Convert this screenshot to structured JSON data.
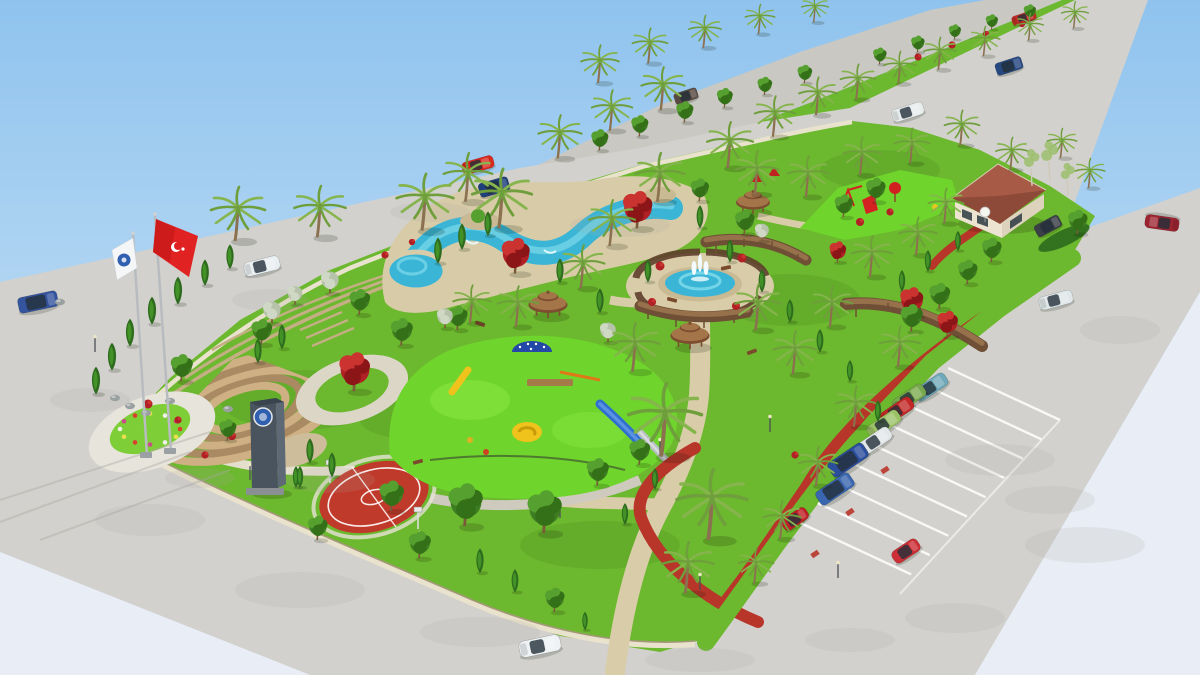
{
  "meta": {
    "alt": "Aerial 3D architectural rendering of a landscaped municipal park with pools, fountain, gazebos, playgrounds, basketball court, amphitheater, flags, parking lot and surrounding roads with cars"
  },
  "palette": {
    "sky_top": "#8fc3ee",
    "sky_bottom": "#ddecf8",
    "haze": "#e9edf5",
    "pavement": "#d2d1cd",
    "road": "#c9c8c3",
    "park_grass": "#6cb82e",
    "grass_bright": "#7ecf37",
    "rubber_green": "#6fd42c",
    "water": "#3ab5d6",
    "water_light": "#8ce2ee",
    "stone_deck": "#d8cca8",
    "sand_path": "#d9cda9",
    "track_red": "#b8352a",
    "court_red": "#c03a2b",
    "wall_light": "#e9e2cc",
    "wall_dark": "#a39878",
    "terrace_tan": "#c4ae84",
    "amphi_tan": "#cfb084",
    "amphi_brown": "#a98a62",
    "palm_frond": "#6f9e3c",
    "palm_frond2": "#86b44d",
    "palm_trunk": "#8c7150",
    "conifer_dark": "#2e6b1e",
    "conifer_light": "#429227",
    "tree_green_1": "#3f7d23",
    "tree_green_2": "#55a02e",
    "tree_green_3": "#347018",
    "red_tree_1": "#b02024",
    "red_tree_2": "#cb3330",
    "red_tree_3": "#8c1518",
    "silver_1": "#b7c2ab",
    "silver_2": "#cfd8c4",
    "birch_leaf": "#9cc06c",
    "gazebo_dark": "#7c4e2f",
    "gazebo_light": "#a5754a",
    "pergola_dark": "#6f4f35",
    "pergola_light": "#96714c",
    "tower_wall": "#8a5a3a",
    "tower_roof": "#9e2a2a",
    "tower_win": "#4a3322",
    "building_roof": "#8e4a38",
    "building_roof_light": "#a75a45",
    "building_wall": "#ece4d0",
    "glass_dark": "#233039",
    "flag_red": "#e02222",
    "flag_white": "#f4f6f8",
    "emblem_blue": "#2f5fae",
    "monument_dark": "#49545e",
    "monument_light": "#5d6974",
    "lamp_gray": "#4a4f52",
    "lamp_head": "#ece6c4",
    "rock_gray": "#9aa0a0",
    "bench_brown": "#7a4a2c",
    "white_line": "#ffffff",
    "blotch": "#a9a7a2",
    "fence_dark": "#3c4a32"
  },
  "scene": {
    "cars": [
      {
        "t": "van",
        "c": "#35549e",
        "x": 38,
        "y": 302,
        "r": -12,
        "s": 1.0
      },
      {
        "t": "sedan",
        "c": "#e9eff1",
        "x": 262,
        "y": 266,
        "r": -14,
        "s": 0.95
      },
      {
        "t": "sedan",
        "c": "#d8291f",
        "x": 478,
        "y": 165,
        "r": -16,
        "s": 0.85
      },
      {
        "t": "suv",
        "c": "#1f3f7a",
        "x": 494,
        "y": 187,
        "r": -16,
        "s": 0.9
      },
      {
        "t": "suv",
        "c": "#584a42",
        "x": 686,
        "y": 96,
        "r": -18,
        "s": 0.7
      },
      {
        "t": "sedan",
        "c": "#bf2d26",
        "x": 1024,
        "y": 18,
        "r": -18,
        "s": 0.65
      },
      {
        "t": "suv",
        "c": "#27477f",
        "x": 1009,
        "y": 66,
        "r": -18,
        "s": 0.8
      },
      {
        "t": "sedan",
        "c": "#e8edee",
        "x": 908,
        "y": 112,
        "r": -18,
        "s": 0.85
      },
      {
        "t": "sedan",
        "c": "#9c2430",
        "x": 1162,
        "y": 223,
        "r": 188,
        "s": 0.9
      },
      {
        "t": "sedan",
        "c": "#dfe7e8",
        "x": 1056,
        "y": 300,
        "r": -15,
        "s": 0.9
      },
      {
        "t": "suv",
        "c": "#3a3f46",
        "x": 1048,
        "y": 226,
        "r": -28,
        "s": 0.8
      },
      {
        "t": "sedan",
        "c": "#6fa8b8",
        "x": 931,
        "y": 387,
        "r": -34,
        "s": 0.95
      },
      {
        "t": "sedan",
        "c": "#79a94e",
        "x": 909,
        "y": 398,
        "r": -34,
        "s": 0.95
      },
      {
        "t": "sedan",
        "c": "#c22626",
        "x": 897,
        "y": 411,
        "r": -34,
        "s": 0.95
      },
      {
        "t": "sedan",
        "c": "#9cc268",
        "x": 884,
        "y": 424,
        "r": -34,
        "s": 0.95
      },
      {
        "t": "sedan",
        "c": "#e2e7e9",
        "x": 875,
        "y": 441,
        "r": -34,
        "s": 0.95
      },
      {
        "t": "van",
        "c": "#2b4e9d",
        "x": 848,
        "y": 460,
        "r": -34,
        "s": 1.05
      },
      {
        "t": "van",
        "c": "#3a66b0",
        "x": 835,
        "y": 489,
        "r": -34,
        "s": 1.0
      },
      {
        "t": "hatch",
        "c": "#bf1f26",
        "x": 795,
        "y": 519,
        "r": -34,
        "s": 0.95
      },
      {
        "t": "hatch",
        "c": "#cc2f36",
        "x": 906,
        "y": 551,
        "r": -34,
        "s": 1.0
      },
      {
        "t": "sedan",
        "c": "#eef2f4",
        "x": 540,
        "y": 646,
        "r": -12,
        "s": 1.1
      }
    ],
    "palms": [
      [
        238,
        208,
        1.0
      ],
      [
        320,
        206,
        0.95
      ],
      [
        425,
        196,
        1.05
      ],
      [
        468,
        172,
        0.9
      ],
      [
        502,
        192,
        1.1
      ],
      [
        560,
        132,
        0.8
      ],
      [
        612,
        106,
        0.75
      ],
      [
        663,
        84,
        0.8
      ],
      [
        730,
        140,
        0.85
      ],
      [
        775,
        112,
        0.75
      ],
      [
        818,
        92,
        0.7
      ],
      [
        858,
        78,
        0.65
      ],
      [
        900,
        64,
        0.6
      ],
      [
        940,
        50,
        0.6
      ],
      [
        985,
        38,
        0.55
      ],
      [
        1030,
        24,
        0.5
      ],
      [
        1075,
        12,
        0.5
      ],
      [
        660,
        172,
        0.9
      ],
      [
        612,
        218,
        0.85
      ],
      [
        583,
        262,
        0.8
      ],
      [
        757,
        168,
        0.8
      ],
      [
        808,
        172,
        0.75
      ],
      [
        862,
        152,
        0.7
      ],
      [
        912,
        142,
        0.65
      ],
      [
        962,
        124,
        0.65
      ],
      [
        1012,
        150,
        0.6
      ],
      [
        1062,
        140,
        0.55
      ],
      [
        1090,
        170,
        0.55
      ],
      [
        665,
        412,
        1.35
      ],
      [
        712,
        497,
        1.3
      ],
      [
        688,
        562,
        0.95
      ],
      [
        635,
        342,
        0.9
      ],
      [
        758,
        302,
        0.85
      ],
      [
        795,
        348,
        0.8
      ],
      [
        832,
        302,
        0.75
      ],
      [
        872,
        252,
        0.75
      ],
      [
        918,
        232,
        0.7
      ],
      [
        946,
        202,
        0.65
      ],
      [
        900,
        342,
        0.75
      ],
      [
        856,
        402,
        0.75
      ],
      [
        818,
        462,
        0.72
      ],
      [
        782,
        516,
        0.7
      ],
      [
        756,
        562,
        0.65
      ],
      [
        518,
        302,
        0.75
      ],
      [
        472,
        300,
        0.7
      ],
      [
        600,
        60,
        0.7
      ],
      [
        650,
        42,
        0.65
      ],
      [
        705,
        28,
        0.6
      ],
      [
        760,
        16,
        0.55
      ],
      [
        815,
        6,
        0.5
      ]
    ],
    "conifers": [
      [
        96,
        382,
        0.9
      ],
      [
        112,
        358,
        0.9
      ],
      [
        130,
        334,
        0.9
      ],
      [
        152,
        312,
        0.9
      ],
      [
        178,
        292,
        0.9
      ],
      [
        205,
        274,
        0.85
      ],
      [
        230,
        258,
        0.8
      ],
      [
        258,
        352,
        0.8
      ],
      [
        282,
        338,
        0.8
      ],
      [
        310,
        452,
        0.8
      ],
      [
        332,
        466,
        0.8
      ],
      [
        272,
        472,
        0.75
      ],
      [
        296,
        478,
        0.7
      ],
      [
        438,
        252,
        0.85
      ],
      [
        462,
        238,
        0.85
      ],
      [
        488,
        225,
        0.8
      ],
      [
        560,
        272,
        0.8
      ],
      [
        600,
        302,
        0.8
      ],
      [
        648,
        272,
        0.75
      ],
      [
        700,
        218,
        0.75
      ],
      [
        730,
        252,
        0.75
      ],
      [
        762,
        282,
        0.75
      ],
      [
        790,
        312,
        0.75
      ],
      [
        820,
        342,
        0.75
      ],
      [
        850,
        372,
        0.7
      ],
      [
        878,
        412,
        0.7
      ],
      [
        480,
        562,
        0.8
      ],
      [
        515,
        582,
        0.75
      ],
      [
        300,
        478,
        0.7
      ],
      [
        902,
        282,
        0.7
      ],
      [
        928,
        262,
        0.7
      ],
      [
        958,
        242,
        0.65
      ],
      [
        655,
        480,
        0.7
      ],
      [
        625,
        515,
        0.7
      ],
      [
        585,
        622,
        0.6
      ]
    ],
    "round_trees": [
      [
        182,
        368,
        0.9
      ],
      [
        262,
        332,
        0.85
      ],
      [
        360,
        302,
        0.85
      ],
      [
        402,
        332,
        0.9
      ],
      [
        466,
        505,
        1.4
      ],
      [
        545,
        512,
        1.4
      ],
      [
        392,
        496,
        1.0
      ],
      [
        420,
        545,
        0.9
      ],
      [
        318,
        528,
        0.8
      ],
      [
        912,
        318,
        0.9
      ],
      [
        940,
        296,
        0.85
      ],
      [
        968,
        272,
        0.8
      ],
      [
        992,
        250,
        0.8
      ],
      [
        1078,
        222,
        0.8
      ],
      [
        598,
        472,
        0.9
      ],
      [
        640,
        452,
        0.85
      ],
      [
        458,
        318,
        0.8
      ],
      [
        876,
        190,
        0.8
      ],
      [
        844,
        206,
        0.75
      ],
      [
        745,
        222,
        0.8
      ],
      [
        700,
        190,
        0.75
      ],
      [
        228,
        430,
        0.7
      ],
      [
        600,
        140,
        0.7
      ],
      [
        640,
        126,
        0.7
      ],
      [
        685,
        112,
        0.7
      ],
      [
        725,
        98,
        0.65
      ],
      [
        765,
        86,
        0.6
      ],
      [
        805,
        74,
        0.6
      ],
      [
        880,
        56,
        0.55
      ],
      [
        918,
        44,
        0.55
      ],
      [
        955,
        32,
        0.5
      ],
      [
        992,
        22,
        0.5
      ],
      [
        1030,
        12,
        0.5
      ],
      [
        555,
        600,
        0.8
      ]
    ],
    "red_trees": [
      [
        516,
        256,
        1.1
      ],
      [
        638,
        210,
        1.15
      ],
      [
        355,
        372,
        1.2
      ],
      [
        912,
        302,
        0.9
      ],
      [
        948,
        324,
        0.8
      ],
      [
        838,
        252,
        0.65
      ]
    ],
    "silver_trees": [
      [
        272,
        312,
        0.95
      ],
      [
        330,
        282,
        0.95
      ],
      [
        445,
        318,
        0.85
      ],
      [
        608,
        332,
        0.85
      ],
      [
        762,
        232,
        0.75
      ],
      [
        295,
        295,
        0.8
      ]
    ],
    "birches": [
      [
        1032,
        168,
        1.0
      ],
      [
        1050,
        162,
        1.1
      ],
      [
        1068,
        180,
        0.9
      ]
    ],
    "gazebos": [
      [
        548,
        302,
        1.15
      ],
      [
        690,
        333,
        1.15
      ],
      [
        753,
        200,
        1.0
      ]
    ],
    "lamps": [
      [
        250,
        480
      ],
      [
        420,
        548
      ],
      [
        660,
        455
      ],
      [
        700,
        590
      ],
      [
        838,
        578
      ],
      [
        560,
        518
      ],
      [
        770,
        432
      ],
      [
        95,
        352
      ]
    ],
    "benches": [
      [
        418,
        462,
        -15
      ],
      [
        596,
        468,
        -10
      ],
      [
        480,
        324,
        20
      ],
      [
        752,
        352,
        -20
      ],
      [
        672,
        300,
        15
      ],
      [
        726,
        268,
        -12
      ]
    ],
    "rocks": [
      [
        115,
        398
      ],
      [
        130,
        406
      ],
      [
        146,
        413
      ],
      [
        170,
        401
      ],
      [
        228,
        409
      ],
      [
        60,
        302
      ]
    ],
    "red_bushes": [
      [
        148,
        404,
        1
      ],
      [
        232,
        436,
        0.9
      ],
      [
        660,
        266,
        1
      ],
      [
        742,
        258,
        1
      ],
      [
        652,
        302,
        0.9
      ],
      [
        736,
        306,
        0.9
      ],
      [
        860,
        222,
        0.9
      ],
      [
        890,
        212,
        0.8
      ],
      [
        918,
        57,
        0.8
      ],
      [
        952,
        45,
        0.8
      ],
      [
        986,
        34,
        0.7
      ],
      [
        1022,
        24,
        0.7
      ],
      [
        795,
        455,
        0.8
      ],
      [
        178,
        420,
        0.8
      ],
      [
        205,
        455,
        0.8
      ],
      [
        385,
        255,
        0.8
      ],
      [
        412,
        242,
        0.7
      ]
    ],
    "grass_shades": [
      [
        300,
        400,
        80,
        30
      ],
      [
        520,
        250,
        90,
        28
      ],
      [
        790,
        300,
        70,
        26
      ],
      [
        600,
        545,
        80,
        24
      ],
      [
        880,
        170,
        60,
        20
      ],
      [
        420,
        420,
        60,
        20
      ]
    ],
    "blotches": [
      [
        150,
        520,
        55,
        16
      ],
      [
        300,
        590,
        65,
        18
      ],
      [
        480,
        632,
        60,
        15
      ],
      [
        90,
        400,
        40,
        12
      ],
      [
        330,
        480,
        45,
        13
      ],
      [
        620,
        225,
        50,
        12
      ],
      [
        430,
        212,
        40,
        10
      ],
      [
        270,
        300,
        38,
        11
      ],
      [
        1000,
        460,
        55,
        16
      ],
      [
        1085,
        545,
        60,
        18
      ],
      [
        1120,
        330,
        40,
        14
      ],
      [
        955,
        618,
        50,
        15
      ],
      [
        700,
        660,
        55,
        12
      ],
      [
        850,
        640,
        45,
        12
      ],
      [
        200,
        478,
        35,
        10
      ],
      [
        1050,
        500,
        45,
        14
      ]
    ],
    "streaks": [
      [
        0,
        500,
        210,
        432
      ],
      [
        0,
        522,
        190,
        452
      ],
      [
        40,
        540,
        230,
        470
      ]
    ],
    "parking": {
      "spine": [
        948,
        368
      ],
      "step": [
        -18.6,
        19.3
      ],
      "count": 9,
      "vec": [
        112,
        52
      ],
      "end_line": [
        [
          1060,
          420
        ],
        [
          900,
          594
        ]
      ],
      "red_marks": [
        [
          885,
          470
        ],
        [
          850,
          512
        ],
        [
          815,
          554
        ]
      ]
    },
    "flower_ring": {
      "cx": 150,
      "cy": 429,
      "rx": 30,
      "ry": 15.5,
      "count": 12,
      "colors": [
        "#d8402e",
        "#ecdf4e",
        "#f0f0ea",
        "#cc4a8a"
      ]
    }
  }
}
